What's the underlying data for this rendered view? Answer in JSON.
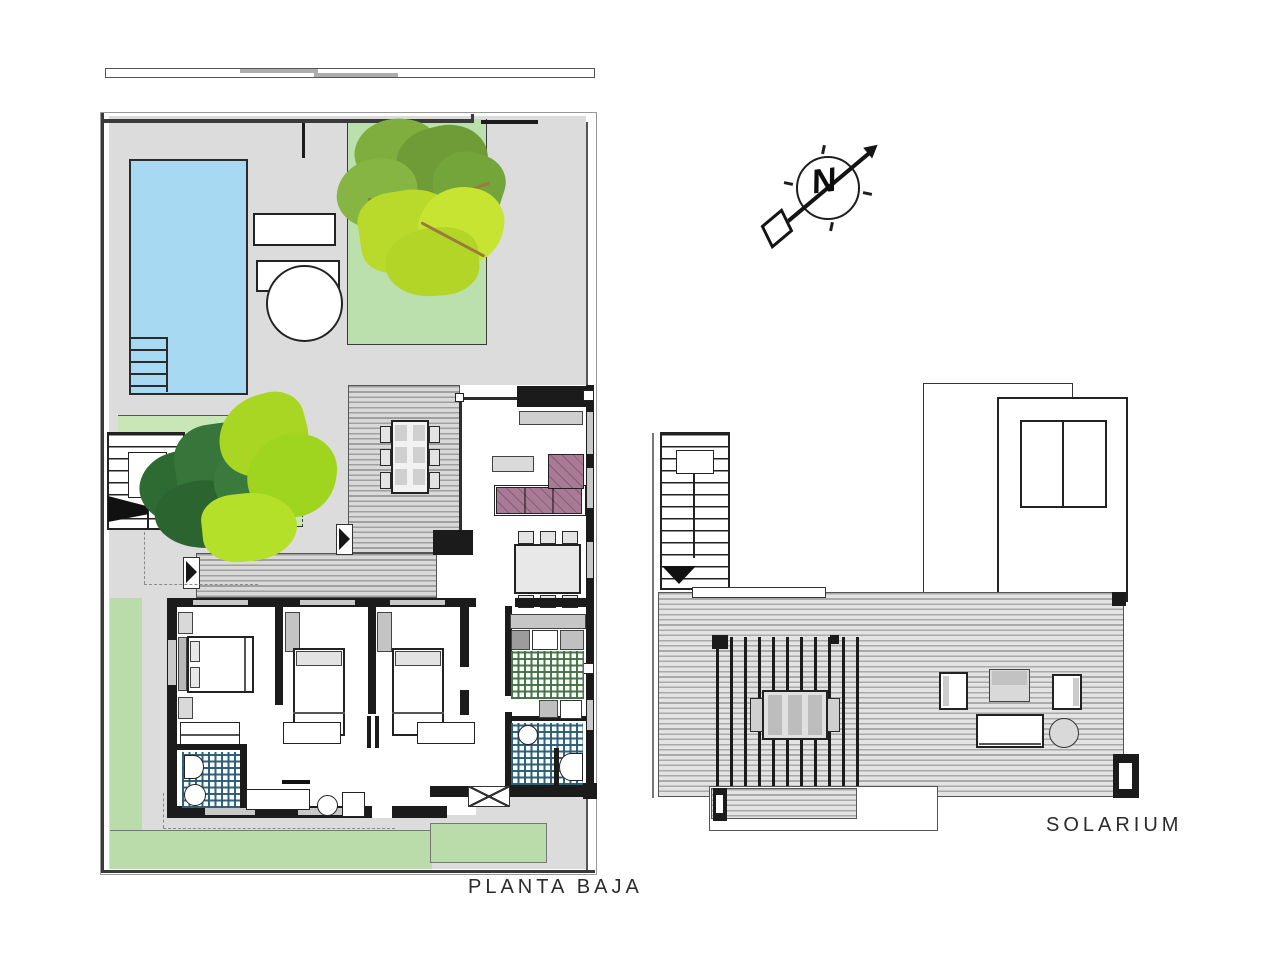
{
  "drawing": {
    "type": "architectural floor plan, two plans side by side",
    "ground_floor": {
      "label": "PLANTA BAJA",
      "elements": [
        "walled plot boundary with entrance gate at top right",
        "swimming pool with corner steps",
        "two sun loungers and round pool table",
        "garden bed with large tree at top",
        "courtyard garden bed with second tree",
        "entry staircase at left with direction arrow",
        "L-shaped timber deck terrace with outdoor dining table for six",
        "living room with corner glass wall, L-shaped sofa, coffee table, sideboard",
        "indoor dining table for six",
        "kitchen with green tiled floor and counter",
        "two bathrooms with blue tiled floors, toilets and basins",
        "three bedrooms with beds, pillows, closets and wardrobes",
        "hallway with console table and stool",
        "lawn strips along left and bottom edges"
      ]
    },
    "solarium": {
      "label": "SOLARIUM",
      "elements": [
        "access staircase with down arrow",
        "stair tower volume with double skylight window",
        "timber roof deck",
        "slatted pergola over outdoor table with chairs",
        "two armchairs, side table, lounge table and round table",
        "lower landing deck at bottom left"
      ]
    },
    "compass": {
      "label": "N",
      "pointing": "north-east"
    }
  },
  "colors": {
    "paper": "#ffffff",
    "terrace_gray": "#dcdcdc",
    "garden_green": "#bcdfae",
    "courtyard_green": "#c9e6b6",
    "pool_blue": "#a8d9f2",
    "wall_black": "#1b1b1b",
    "sofa_mauve": "#a97a95",
    "kitchen_tile_green": "#3e7040",
    "bath_tile_blue": "#265c74",
    "tree_dark_green": "#2e6b33",
    "tree_olive": "#76a23b",
    "tree_lime": "#b6dc2a",
    "branch_brown": "#9a7b3a"
  }
}
